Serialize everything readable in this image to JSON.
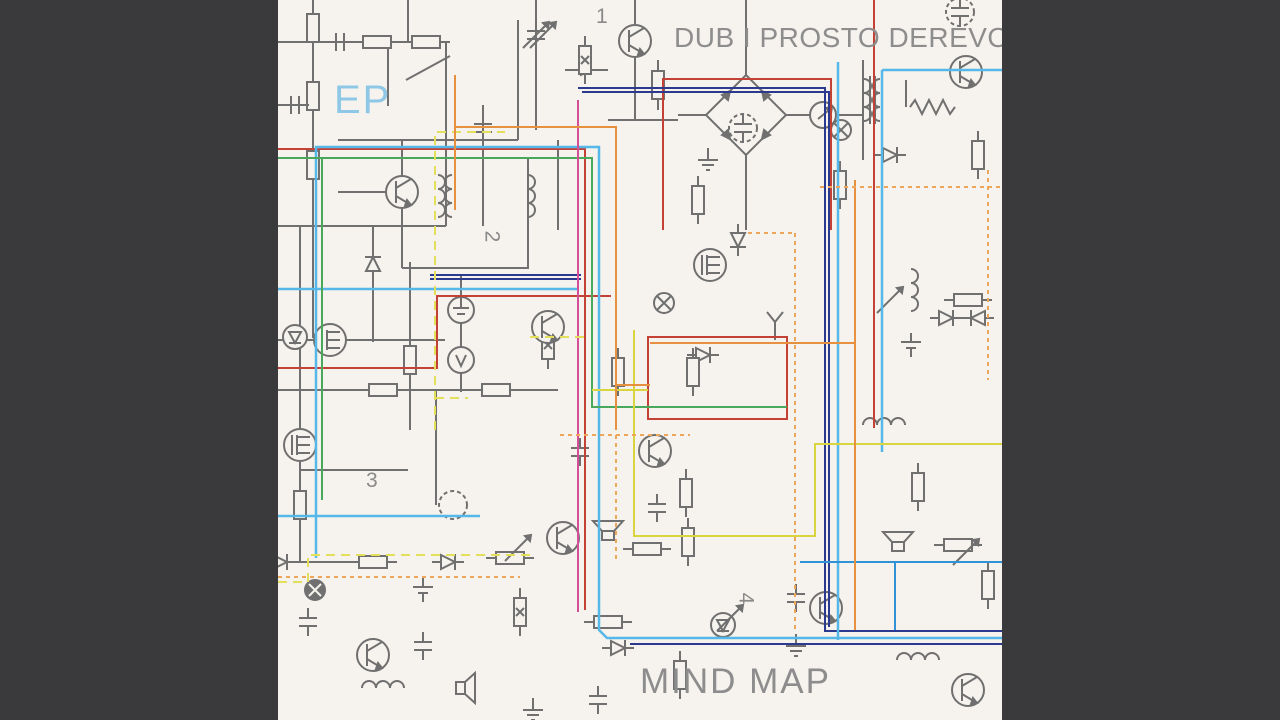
{
  "artwork": {
    "artist_title": "DUB I PROSTO DEREVO",
    "ep_label": "EP",
    "album_title": "MIND MAP",
    "markers": {
      "m1": "1",
      "m2": "2",
      "m3": "3",
      "m4": "4"
    }
  },
  "palette": {
    "letterbox": "#3a3a3c",
    "paper": "#f6f3ee",
    "schematic_gray": "#707070",
    "text_gray": "#8d8d8d",
    "ep_blue": "#8fc8e6",
    "red": "#c44136",
    "navy": "#2b3a8f",
    "cyan": "#56b7e9",
    "blue": "#3193d6",
    "green": "#49a85c",
    "magenta": "#d44f97",
    "yellow": "#d9d53f",
    "yellow_dashed": "#e3df5b",
    "orange": "#e59140",
    "orange_dashed": "#eda65a"
  }
}
